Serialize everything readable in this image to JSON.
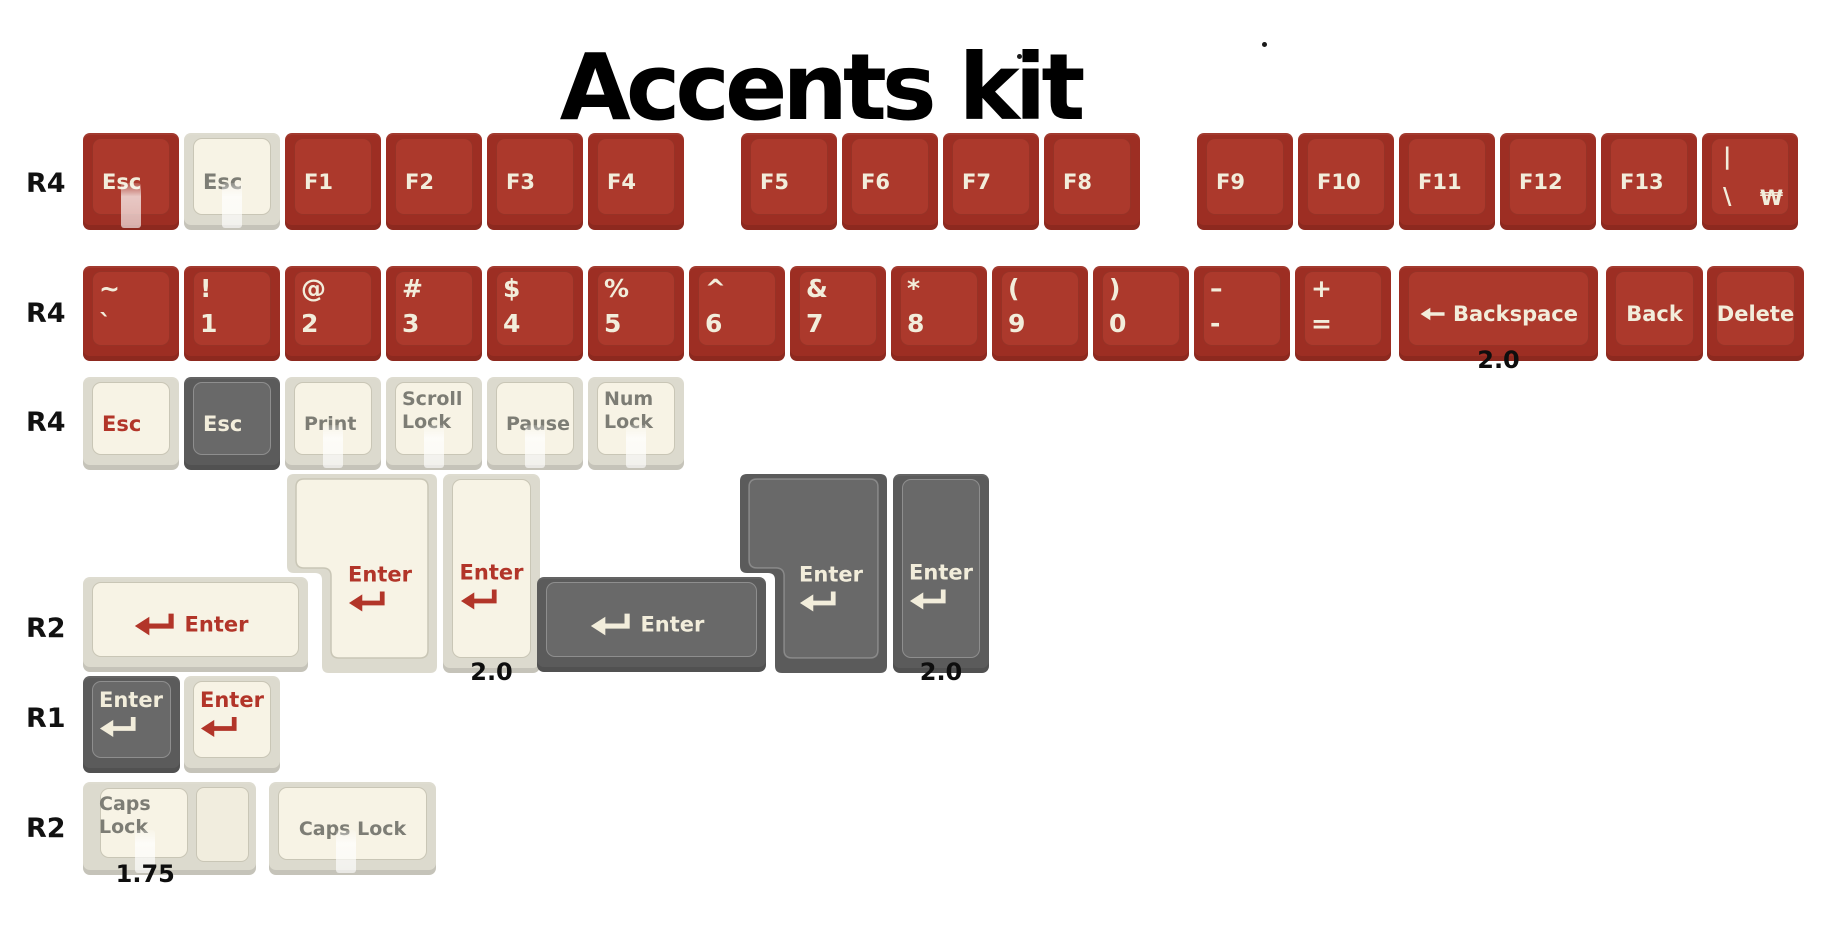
{
  "title": {
    "text": "Accents kit"
  },
  "dots": [
    {
      "x": 1017,
      "y": 54
    },
    {
      "x": 1262,
      "y": 42
    }
  ],
  "row_labels": [
    {
      "text": "R4",
      "x": 26,
      "y": 168
    },
    {
      "text": "R4",
      "x": 26,
      "y": 298
    },
    {
      "text": "R4",
      "x": 26,
      "y": 407
    },
    {
      "text": "R2",
      "x": 26,
      "y": 613
    },
    {
      "text": "R1",
      "x": 26,
      "y": 703
    },
    {
      "text": "R2",
      "x": 26,
      "y": 813
    }
  ],
  "colors": {
    "red_base": "#9D2E23",
    "red_face": "#AC392C",
    "red_face_border": "rgba(0,0,0,0.12)",
    "cream_base": "#DCDACE",
    "cream_face": "#F7F3E5",
    "cream_face_border": "#C9C6B6",
    "cream_step_face": "#F1EDDE",
    "gray_base": "#5B5B5B",
    "gray_face": "#696969",
    "gray_face_border": "rgba(255,255,255,0.25)",
    "legend_cream": "#F2EDDB",
    "legend_red": "#B23529",
    "legend_gray": "#7D7D75",
    "size_label_color": "#0E0E0E"
  },
  "icons": {
    "enter": "return-arrow-icon",
    "backspace": "left-arrow-icon"
  },
  "keys": [
    {
      "name": "esc-red",
      "x": 83,
      "y": 133,
      "w": 96,
      "h": 97,
      "scheme": "red",
      "legend": {
        "type": "single",
        "text": "Esc",
        "color": "cream",
        "align": "left"
      },
      "shine": true
    },
    {
      "name": "esc-cream",
      "x": 184,
      "y": 133,
      "w": 96,
      "h": 97,
      "scheme": "cream",
      "legend": {
        "type": "single",
        "text": "Esc",
        "color": "gray",
        "align": "left"
      },
      "shine": true
    },
    {
      "name": "f1",
      "x": 285,
      "y": 133,
      "w": 96,
      "h": 97,
      "scheme": "red",
      "legend": {
        "type": "single",
        "text": "F1",
        "color": "cream",
        "align": "left"
      }
    },
    {
      "name": "f2",
      "x": 386,
      "y": 133,
      "w": 96,
      "h": 97,
      "scheme": "red",
      "legend": {
        "type": "single",
        "text": "F2",
        "color": "cream",
        "align": "left"
      }
    },
    {
      "name": "f3",
      "x": 487,
      "y": 133,
      "w": 96,
      "h": 97,
      "scheme": "red",
      "legend": {
        "type": "single",
        "text": "F3",
        "color": "cream",
        "align": "left"
      }
    },
    {
      "name": "f4",
      "x": 588,
      "y": 133,
      "w": 96,
      "h": 97,
      "scheme": "red",
      "legend": {
        "type": "single",
        "text": "F4",
        "color": "cream",
        "align": "left"
      }
    },
    {
      "name": "f5",
      "x": 741,
      "y": 133,
      "w": 96,
      "h": 97,
      "scheme": "red",
      "legend": {
        "type": "single",
        "text": "F5",
        "color": "cream",
        "align": "left"
      }
    },
    {
      "name": "f6",
      "x": 842,
      "y": 133,
      "w": 96,
      "h": 97,
      "scheme": "red",
      "legend": {
        "type": "single",
        "text": "F6",
        "color": "cream",
        "align": "left"
      }
    },
    {
      "name": "f7",
      "x": 943,
      "y": 133,
      "w": 96,
      "h": 97,
      "scheme": "red",
      "legend": {
        "type": "single",
        "text": "F7",
        "color": "cream",
        "align": "left"
      }
    },
    {
      "name": "f8",
      "x": 1044,
      "y": 133,
      "w": 96,
      "h": 97,
      "scheme": "red",
      "legend": {
        "type": "single",
        "text": "F8",
        "color": "cream",
        "align": "left"
      }
    },
    {
      "name": "f9",
      "x": 1197,
      "y": 133,
      "w": 96,
      "h": 97,
      "scheme": "red",
      "legend": {
        "type": "single",
        "text": "F9",
        "color": "cream",
        "align": "left"
      }
    },
    {
      "name": "f10",
      "x": 1298,
      "y": 133,
      "w": 96,
      "h": 97,
      "scheme": "red",
      "legend": {
        "type": "single",
        "text": "F10",
        "color": "cream",
        "align": "left"
      }
    },
    {
      "name": "f11",
      "x": 1399,
      "y": 133,
      "w": 96,
      "h": 97,
      "scheme": "red",
      "legend": {
        "type": "single",
        "text": "F11",
        "color": "cream",
        "align": "left"
      }
    },
    {
      "name": "f12",
      "x": 1500,
      "y": 133,
      "w": 96,
      "h": 97,
      "scheme": "red",
      "legend": {
        "type": "single",
        "text": "F12",
        "color": "cream",
        "align": "left"
      }
    },
    {
      "name": "f13",
      "x": 1601,
      "y": 133,
      "w": 96,
      "h": 97,
      "scheme": "red",
      "legend": {
        "type": "single",
        "text": "F13",
        "color": "cream",
        "align": "left"
      }
    },
    {
      "name": "pipe-backslash-won",
      "x": 1702,
      "y": 133,
      "w": 96,
      "h": 97,
      "scheme": "red",
      "legend": {
        "type": "pipe",
        "top": "|",
        "bottom_left": "\\",
        "bottom_right": "₩",
        "color": "cream"
      }
    },
    {
      "name": "tilde-grave",
      "x": 83,
      "y": 266,
      "w": 96,
      "h": 95,
      "scheme": "red",
      "legend": {
        "type": "sym",
        "lines": [
          "~",
          "`"
        ],
        "color": "cream"
      }
    },
    {
      "name": "num1",
      "x": 184,
      "y": 266,
      "w": 96,
      "h": 95,
      "scheme": "red",
      "legend": {
        "type": "sym",
        "lines": [
          "!",
          "1"
        ],
        "color": "cream"
      }
    },
    {
      "name": "num2",
      "x": 285,
      "y": 266,
      "w": 96,
      "h": 95,
      "scheme": "red",
      "legend": {
        "type": "sym",
        "lines": [
          "@",
          "2"
        ],
        "color": "cream"
      }
    },
    {
      "name": "num3",
      "x": 386,
      "y": 266,
      "w": 96,
      "h": 95,
      "scheme": "red",
      "legend": {
        "type": "sym",
        "lines": [
          "#",
          "3"
        ],
        "color": "cream"
      }
    },
    {
      "name": "num4",
      "x": 487,
      "y": 266,
      "w": 96,
      "h": 95,
      "scheme": "red",
      "legend": {
        "type": "sym",
        "lines": [
          "$",
          "4"
        ],
        "color": "cream"
      }
    },
    {
      "name": "num5",
      "x": 588,
      "y": 266,
      "w": 96,
      "h": 95,
      "scheme": "red",
      "legend": {
        "type": "sym",
        "lines": [
          "%",
          "5"
        ],
        "color": "cream"
      }
    },
    {
      "name": "num6",
      "x": 689,
      "y": 266,
      "w": 96,
      "h": 95,
      "scheme": "red",
      "legend": {
        "type": "sym",
        "lines": [
          "^",
          "6"
        ],
        "color": "cream"
      }
    },
    {
      "name": "num7",
      "x": 790,
      "y": 266,
      "w": 96,
      "h": 95,
      "scheme": "red",
      "legend": {
        "type": "sym",
        "lines": [
          "&",
          "7"
        ],
        "color": "cream"
      }
    },
    {
      "name": "num8",
      "x": 891,
      "y": 266,
      "w": 96,
      "h": 95,
      "scheme": "red",
      "legend": {
        "type": "sym",
        "lines": [
          "*",
          "8"
        ],
        "color": "cream"
      }
    },
    {
      "name": "num9",
      "x": 992,
      "y": 266,
      "w": 96,
      "h": 95,
      "scheme": "red",
      "legend": {
        "type": "sym",
        "lines": [
          "(",
          "9"
        ],
        "color": "cream"
      }
    },
    {
      "name": "num0",
      "x": 1093,
      "y": 266,
      "w": 96,
      "h": 95,
      "scheme": "red",
      "legend": {
        "type": "sym",
        "lines": [
          ")",
          "0"
        ],
        "color": "cream"
      }
    },
    {
      "name": "minus-underscore",
      "x": 1194,
      "y": 266,
      "w": 96,
      "h": 95,
      "scheme": "red",
      "legend": {
        "type": "sym",
        "lines": [
          "–",
          "-"
        ],
        "color": "cream"
      }
    },
    {
      "name": "plus-equals",
      "x": 1295,
      "y": 266,
      "w": 96,
      "h": 95,
      "scheme": "red",
      "legend": {
        "type": "sym",
        "lines": [
          "+",
          "="
        ],
        "color": "cream"
      }
    },
    {
      "name": "backspace",
      "x": 1399,
      "y": 266,
      "w": 199,
      "h": 95,
      "scheme": "red",
      "legend": {
        "type": "backspace",
        "text": "Backspace",
        "color": "cream"
      },
      "size_label": "2.0"
    },
    {
      "name": "back",
      "x": 1606,
      "y": 266,
      "w": 97,
      "h": 95,
      "scheme": "red",
      "legend": {
        "type": "single",
        "text": "Back",
        "color": "cream",
        "align": "center"
      }
    },
    {
      "name": "delete",
      "x": 1707,
      "y": 266,
      "w": 97,
      "h": 95,
      "scheme": "red",
      "legend": {
        "type": "single",
        "text": "Delete",
        "color": "cream",
        "align": "center"
      }
    },
    {
      "name": "esc-accent-cream",
      "x": 83,
      "y": 377,
      "w": 96,
      "h": 93,
      "scheme": "cream",
      "legend": {
        "type": "single",
        "text": "Esc",
        "color": "red",
        "align": "left"
      }
    },
    {
      "name": "esc-dark-gray",
      "x": 184,
      "y": 377,
      "w": 96,
      "h": 93,
      "scheme": "gray",
      "legend": {
        "type": "single",
        "text": "Esc",
        "color": "cream",
        "align": "left"
      }
    },
    {
      "name": "print",
      "x": 285,
      "y": 377,
      "w": 96,
      "h": 93,
      "scheme": "cream",
      "legend": {
        "type": "single",
        "text": "Print",
        "color": "gray",
        "align": "left",
        "size": 19
      },
      "shine": true
    },
    {
      "name": "scroll-lock",
      "x": 386,
      "y": 377,
      "w": 96,
      "h": 93,
      "scheme": "cream",
      "legend": {
        "type": "lines",
        "lines": [
          "Scroll",
          "Lock"
        ],
        "color": "gray"
      },
      "shine": true
    },
    {
      "name": "pause",
      "x": 487,
      "y": 377,
      "w": 96,
      "h": 93,
      "scheme": "cream",
      "legend": {
        "type": "single",
        "text": "Pause",
        "color": "gray",
        "align": "left",
        "size": 19
      },
      "shine": true
    },
    {
      "name": "num-lock",
      "x": 588,
      "y": 377,
      "w": 96,
      "h": 93,
      "scheme": "cream",
      "legend": {
        "type": "lines",
        "lines": [
          "Num",
          "Lock"
        ],
        "color": "gray"
      },
      "shine": true
    },
    {
      "name": "iso-enter-cream",
      "x": 287,
      "y": 474,
      "w": 150,
      "h": 199,
      "scheme": "cream",
      "shape": "iso",
      "iso": {
        "topH": 99,
        "off": 35
      },
      "legend": {
        "type": "enter-v",
        "text": "Enter",
        "color": "red",
        "pos": "iso"
      }
    },
    {
      "name": "tall-enter-cream",
      "x": 443,
      "y": 474,
      "w": 97,
      "h": 199,
      "scheme": "cream",
      "legend": {
        "type": "enter-v",
        "text": "Enter",
        "color": "red",
        "pos": "tall"
      },
      "size_label": "2.0"
    },
    {
      "name": "wide-enter-cream",
      "x": 83,
      "y": 577,
      "w": 225,
      "h": 95,
      "scheme": "cream",
      "legend": {
        "type": "enter-h",
        "text": "Enter",
        "color": "red"
      }
    },
    {
      "name": "wide-enter-gray",
      "x": 537,
      "y": 577,
      "w": 229,
      "h": 95,
      "scheme": "gray",
      "legend": {
        "type": "enter-h",
        "text": "Enter",
        "color": "cream"
      }
    },
    {
      "name": "iso-enter-gray",
      "x": 740,
      "y": 474,
      "w": 147,
      "h": 199,
      "scheme": "gray",
      "shape": "iso",
      "iso": {
        "topH": 99,
        "off": 35
      },
      "legend": {
        "type": "enter-v",
        "text": "Enter",
        "color": "cream",
        "pos": "iso"
      }
    },
    {
      "name": "tall-enter-gray",
      "x": 893,
      "y": 474,
      "w": 96,
      "h": 199,
      "scheme": "gray",
      "legend": {
        "type": "enter-v",
        "text": "Enter",
        "color": "cream",
        "pos": "tall"
      },
      "size_label": "2.0"
    },
    {
      "name": "enter-small-gray",
      "x": 83,
      "y": 676,
      "w": 97,
      "h": 97,
      "scheme": "gray",
      "legend": {
        "type": "enter-v",
        "text": "Enter",
        "color": "cream",
        "pos": "tl"
      }
    },
    {
      "name": "enter-small-cream",
      "x": 184,
      "y": 676,
      "w": 96,
      "h": 97,
      "scheme": "cream",
      "legend": {
        "type": "enter-v",
        "text": "Enter",
        "color": "red",
        "pos": "tl"
      }
    },
    {
      "name": "caps-lock-stepped",
      "x": 83,
      "y": 782,
      "w": 173,
      "h": 93,
      "scheme": "cream",
      "shape": "step",
      "legend": {
        "type": "lines",
        "lines": [
          "Caps",
          "Lock"
        ],
        "color": "gray"
      },
      "shine": true,
      "shine_left": 36,
      "size_label": "1.75",
      "size_label_left": 36
    },
    {
      "name": "caps-lock-wide",
      "x": 269,
      "y": 782,
      "w": 167,
      "h": 93,
      "scheme": "cream",
      "legend": {
        "type": "single",
        "text": "Caps Lock",
        "color": "gray",
        "align": "center",
        "size": 19
      },
      "shine": true,
      "shine_left": 46
    }
  ]
}
